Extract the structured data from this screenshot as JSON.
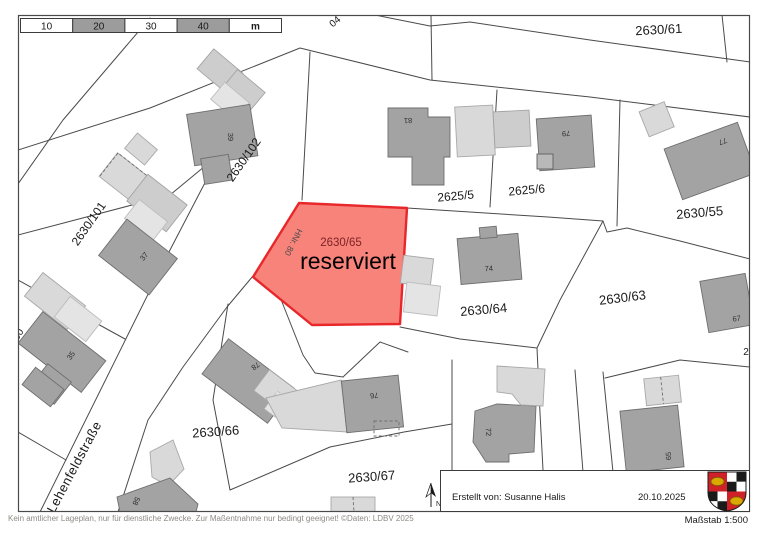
{
  "scale_bar": {
    "labels": [
      "10",
      "20",
      "30",
      "40",
      "m"
    ]
  },
  "map": {
    "street_label": "Lehenfeldstraße",
    "cut_labels": {
      "top": "04",
      "left": "00",
      "right": "2"
    },
    "reserved": {
      "parcel_number": "2630/65",
      "status_text": "reserviert",
      "house_number": "HNr. 80"
    },
    "parcel_labels": {
      "p2630_61": "2630/61",
      "p2630_102": "2630/102",
      "p2630_101": "2630/101",
      "p2625_5": "2625/5",
      "p2625_6": "2625/6",
      "p2630_55": "2630/55",
      "p2630_63": "2630/63",
      "p2630_64": "2630/64",
      "p2630_66": "2630/66",
      "p2630_67": "2630/67"
    },
    "house_numbers": {
      "h39": "39",
      "h37": "37",
      "h35": "35",
      "h58": "58",
      "h81": "81",
      "h79": "79",
      "h77": "77",
      "h74": "74",
      "h67": "67",
      "h78": "78",
      "h76": "76",
      "h72": "72",
      "h65": "65"
    },
    "north_label": "N"
  },
  "footer": {
    "disclaimer": "Kein amtlicher Lageplan, nur für dienstliche Zwecke. Zur Maßentnahme nur bedingt geeignet! ©Daten: LDBV 2025",
    "created_by": "Erstellt von: Susanne Halis",
    "date": "20.10.2025",
    "scale_text": "Maßstab 1:500"
  },
  "colors": {
    "reserved_fill": "#f8837b",
    "reserved_stroke": "#e8272b",
    "building_dark": "#a3a3a3",
    "building_light": "#d9d9d9",
    "line": "#4a4a4a"
  }
}
